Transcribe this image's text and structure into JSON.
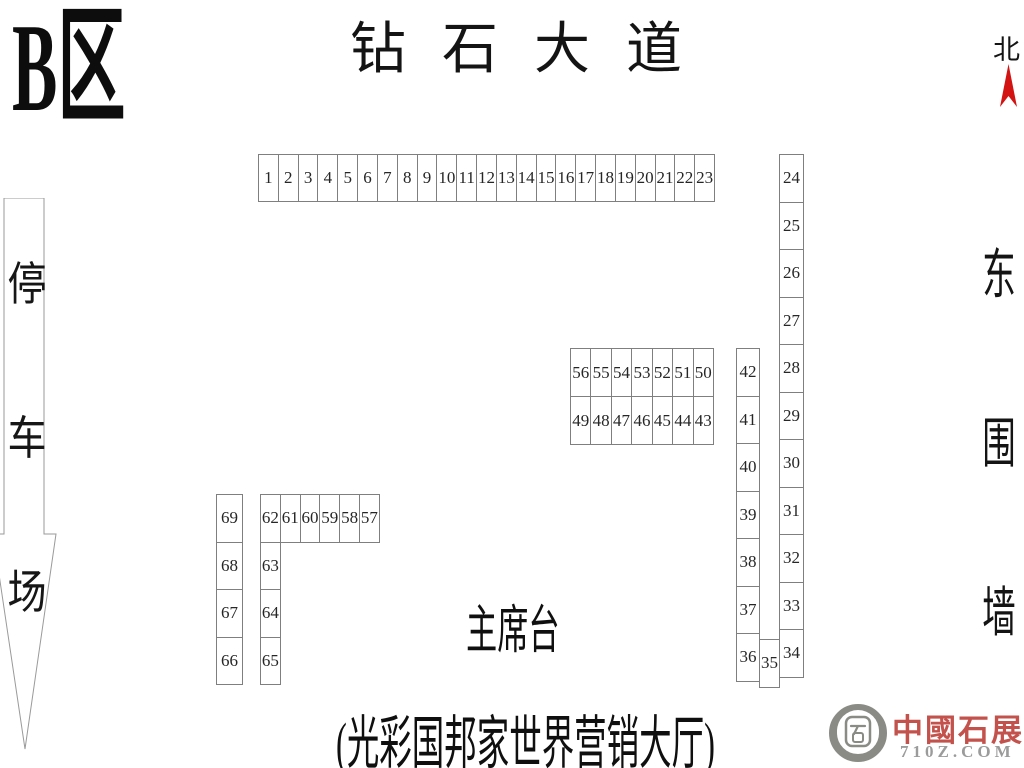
{
  "zone": {
    "label": "B区"
  },
  "street": {
    "label": "钻石大道"
  },
  "compass": {
    "label": "北",
    "arrow_color": "#d31212"
  },
  "east_wall": {
    "chars": [
      "东",
      "围",
      "墙"
    ]
  },
  "parking": {
    "chars": [
      "停",
      "车",
      "场"
    ]
  },
  "stage": {
    "label": "主席台"
  },
  "hall": {
    "label": "(光彩国邦家世界营销大厅)"
  },
  "logo": {
    "name": "中國石展網",
    "domain": "710Z.COM",
    "text_color": "#c4524c",
    "icon_color": "#8b8b86",
    "icon": "stone-seal-icon"
  },
  "colors": {
    "booth_border": "#7f7f7f",
    "booth_number": "#262626",
    "text": "#141414",
    "arrow_outline": "#9a9a9a"
  },
  "booth_groups": [
    {
      "name": "booth-row-top",
      "dir": "h",
      "x": 258,
      "y": 154,
      "cell_w": 20.83,
      "cell_h": 48,
      "numbers": [
        1,
        2,
        3,
        4,
        5,
        6,
        7,
        8,
        9,
        10,
        11,
        12,
        13,
        14,
        15,
        16,
        17,
        18,
        19,
        20,
        21,
        22,
        23
      ]
    },
    {
      "name": "booth-col-right-outer",
      "dir": "v",
      "x": 779,
      "y": 154,
      "cell_w": 25,
      "cell_h": 48.5,
      "numbers": [
        24,
        25,
        26,
        27,
        28,
        29,
        30,
        31,
        32,
        33,
        34
      ]
    },
    {
      "name": "booth-row-mid-upper",
      "dir": "h",
      "x": 570,
      "y": 348,
      "cell_w": 21.43,
      "cell_h": 49,
      "numbers": [
        56,
        55,
        54,
        53,
        52,
        51,
        50
      ]
    },
    {
      "name": "booth-row-mid-lower",
      "dir": "h",
      "x": 570,
      "y": 396,
      "cell_w": 21.43,
      "cell_h": 49,
      "numbers": [
        49,
        48,
        47,
        46,
        45,
        44,
        43
      ]
    },
    {
      "name": "booth-col-right-inner",
      "dir": "v",
      "x": 736,
      "y": 348,
      "cell_w": 24,
      "cell_h": 48.5,
      "numbers": [
        42,
        41,
        40,
        39,
        38,
        37,
        36
      ]
    },
    {
      "name": "booth-cell-35-group",
      "dir": "h",
      "x": 759,
      "y": 639,
      "cell_w": 21,
      "cell_h": 48.5,
      "numbers": [
        35
      ]
    },
    {
      "name": "booth-col-left-outer",
      "dir": "v",
      "x": 216,
      "y": 494,
      "cell_w": 27,
      "cell_h": 48.5,
      "numbers": [
        69,
        68,
        67,
        66
      ]
    },
    {
      "name": "booth-row-left",
      "dir": "h",
      "x": 260,
      "y": 494,
      "cell_w": 20.8,
      "cell_h": 48.5,
      "numbers": [
        62,
        61,
        60,
        59,
        58,
        57
      ]
    },
    {
      "name": "booth-col-left-inner",
      "dir": "v",
      "x": 260,
      "y": 541.5,
      "cell_w": 20.8,
      "cell_h": 48.5,
      "numbers": [
        63,
        64,
        65
      ]
    }
  ]
}
